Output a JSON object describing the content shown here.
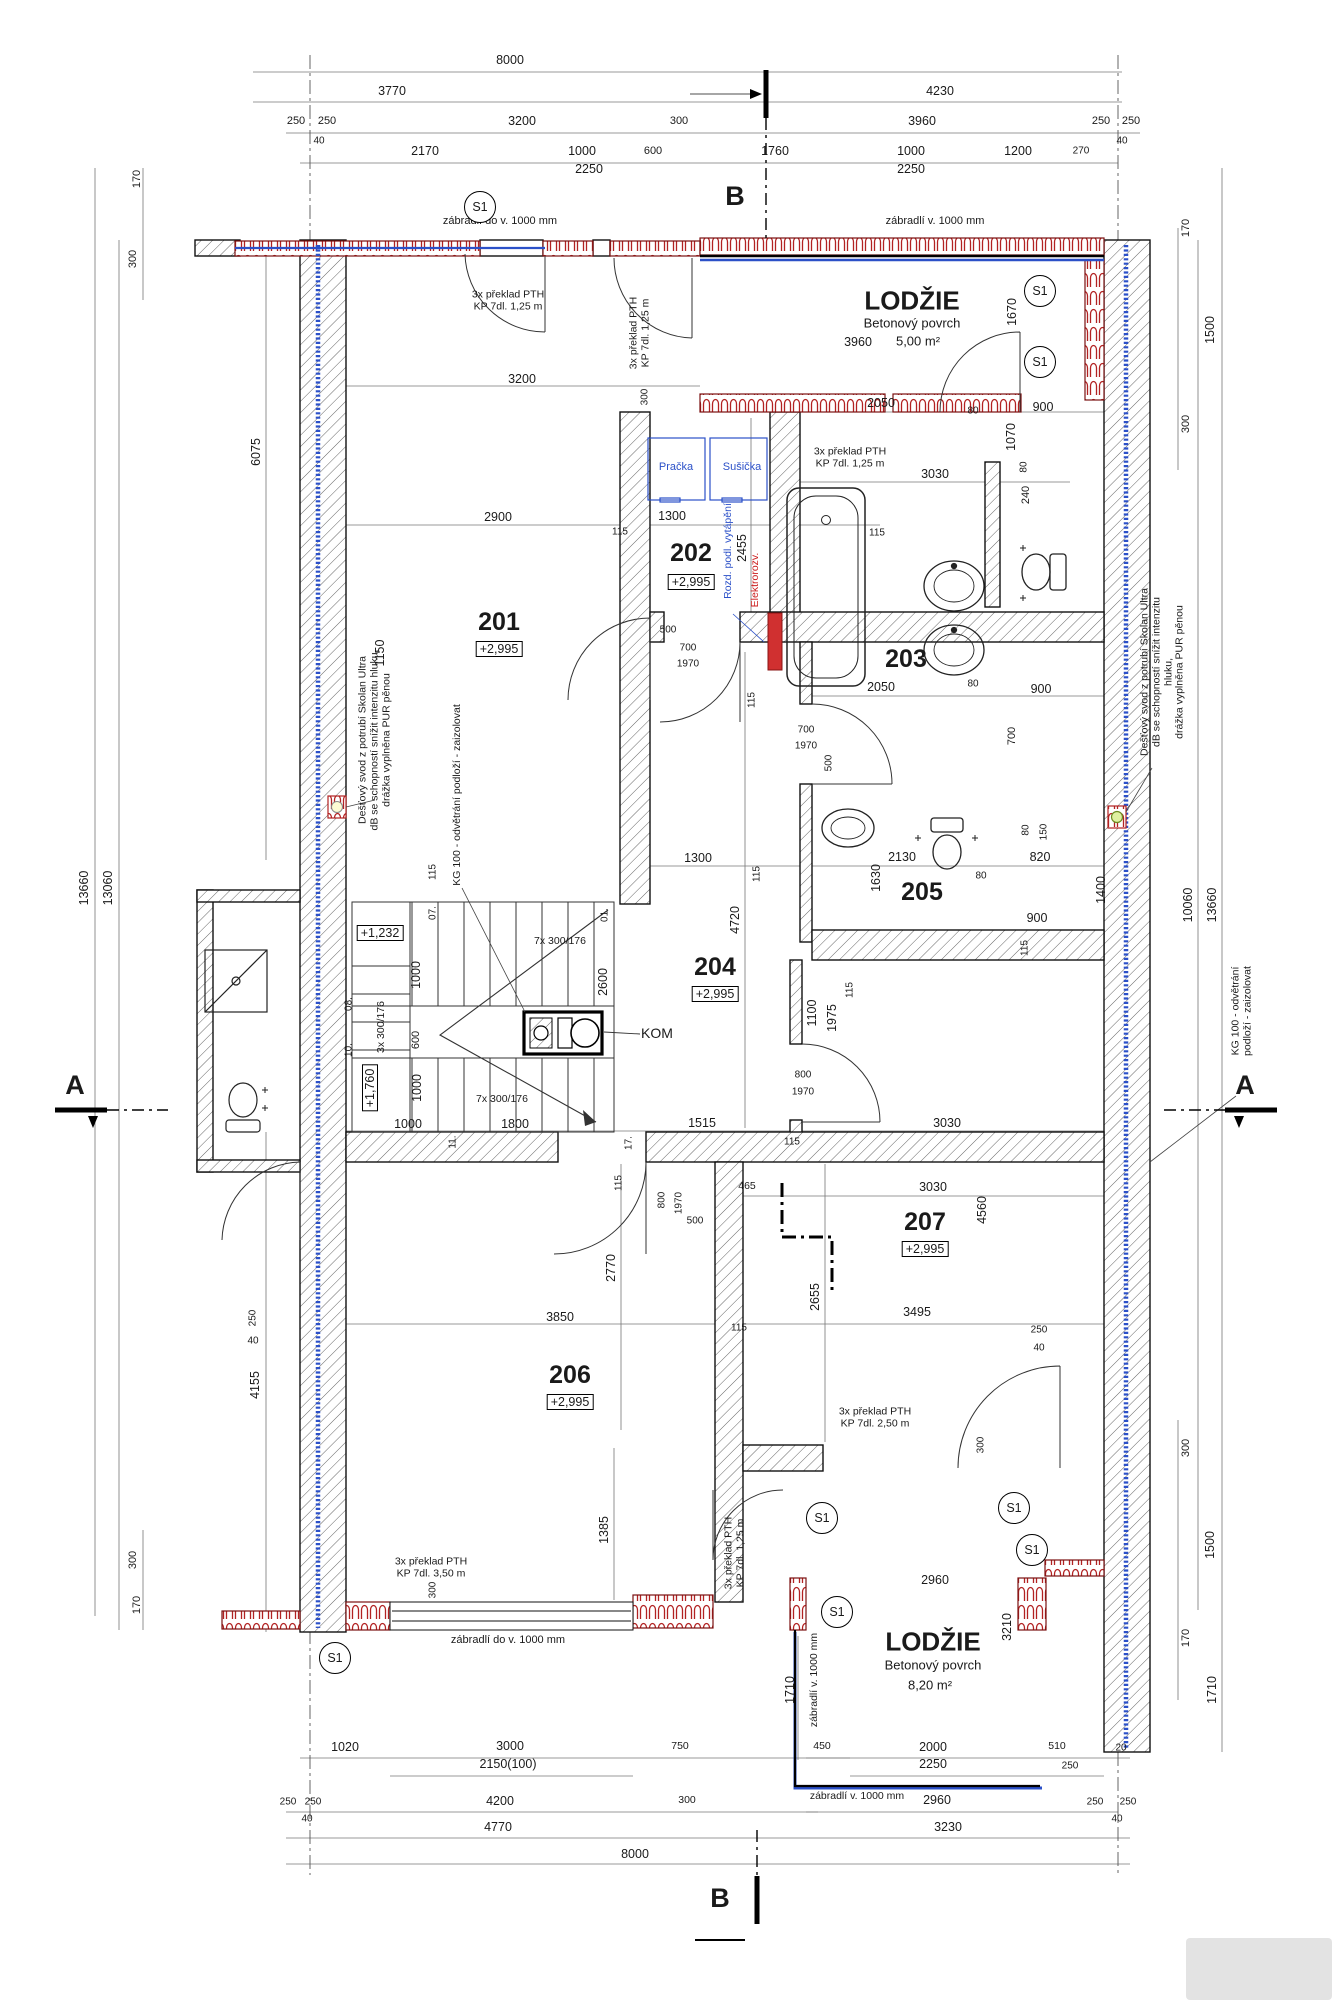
{
  "meta": {
    "drawing_type": "architectural floor plan, 2nd storey",
    "units": "mm"
  },
  "colors": {
    "wall_hatch": "#555555",
    "brick_red": "#b22222",
    "pipe_blue": "#2b50c8",
    "note_blue": "#2b50c8",
    "note_red": "#cc1f1f",
    "line": "#1a1a1a"
  },
  "rooms": [
    {
      "number": "201",
      "level": "+2,995"
    },
    {
      "number": "202",
      "level": "+2,995"
    },
    {
      "number": "203",
      "level": ""
    },
    {
      "number": "204",
      "level": "+2,995"
    },
    {
      "number": "205",
      "level": ""
    },
    {
      "number": "206",
      "level": "+2,995"
    },
    {
      "number": "207",
      "level": "+2,995"
    },
    {
      "name": "LODŽIE",
      "surface": "Betonový povrch",
      "area": "5,00 m²"
    },
    {
      "name": "LODŽIE",
      "surface": "Betonový povrch",
      "area": "8,20 m²"
    }
  ],
  "annotations": [
    {
      "t": "8000",
      "x": 510,
      "y": 60
    },
    {
      "t": "3770",
      "x": 392,
      "y": 91
    },
    {
      "t": "4230",
      "x": 940,
      "y": 91
    },
    {
      "t": "250",
      "x": 296,
      "y": 121,
      "s": 11
    },
    {
      "t": "250",
      "x": 327,
      "y": 121,
      "s": 11
    },
    {
      "t": "40",
      "x": 319,
      "y": 141,
      "s": 10
    },
    {
      "t": "3200",
      "x": 522,
      "y": 121
    },
    {
      "t": "300",
      "x": 679,
      "y": 121,
      "s": 11
    },
    {
      "t": "3960",
      "x": 922,
      "y": 121
    },
    {
      "t": "250",
      "x": 1101,
      "y": 121,
      "s": 11
    },
    {
      "t": "250",
      "x": 1131,
      "y": 121,
      "s": 11
    },
    {
      "t": "40",
      "x": 1122,
      "y": 141,
      "s": 10
    },
    {
      "t": "2170",
      "x": 425,
      "y": 151
    },
    {
      "t": "1000",
      "x": 582,
      "y": 151
    },
    {
      "t": "600",
      "x": 653,
      "y": 151,
      "s": 11
    },
    {
      "t": "1760",
      "x": 775,
      "y": 151
    },
    {
      "t": "1000",
      "x": 911,
      "y": 151
    },
    {
      "t": "1200",
      "x": 1018,
      "y": 151
    },
    {
      "t": "270",
      "x": 1081,
      "y": 151,
      "s": 10
    },
    {
      "t": "2250",
      "x": 589,
      "y": 169
    },
    {
      "t": "2250",
      "x": 911,
      "y": 169
    },
    {
      "t": "B",
      "x": 735,
      "y": 196,
      "s": 27,
      "b": 1,
      "n": "section-marker-b"
    },
    {
      "t": "zábradlí do v. 1000 mm",
      "x": 500,
      "y": 221,
      "s": 11,
      "n": "railing-note"
    },
    {
      "t": "zábradlí v. 1000 mm",
      "x": 935,
      "y": 221,
      "s": 11,
      "n": "railing-note"
    },
    {
      "t": "S1",
      "x": 480,
      "y": 207,
      "o": "circ",
      "n": "detail-marker"
    },
    {
      "t": "S1",
      "x": 1040,
      "y": 291,
      "o": "circ",
      "n": "detail-marker"
    },
    {
      "t": "S1",
      "x": 1040,
      "y": 362,
      "o": "circ",
      "n": "detail-marker"
    },
    {
      "t": "170",
      "x": 137,
      "y": 179,
      "r": -90,
      "s": 11
    },
    {
      "t": "300",
      "x": 133,
      "y": 259,
      "r": -90,
      "s": 11
    },
    {
      "t": "170",
      "x": 1186,
      "y": 228,
      "r": -90,
      "s": 11
    },
    {
      "t": "1500",
      "x": 1210,
      "y": 330,
      "r": -90
    },
    {
      "t": "300",
      "x": 1186,
      "y": 424,
      "r": -90,
      "s": 11
    },
    {
      "t": "1670",
      "x": 1012,
      "y": 312,
      "r": -90
    },
    {
      "t": "3x překlad PTH\nKP 7dl. 1,25 m",
      "x": 508,
      "y": 301,
      "s": 10.5,
      "n": "lintel-note"
    },
    {
      "t": "3x překlad PTH\nKP 7dl. 1,25 m",
      "x": 640,
      "y": 333,
      "r": -90,
      "s": 10.5,
      "n": "lintel-note"
    },
    {
      "t": "LODŽIE",
      "x": 912,
      "y": 301,
      "s": 26,
      "b": 1,
      "n": "room-label"
    },
    {
      "t": "Betonový povrch",
      "x": 912,
      "y": 324,
      "s": 13,
      "n": "room-sublabel"
    },
    {
      "t": "5,00 m²",
      "x": 918,
      "y": 342,
      "s": 13,
      "n": "room-area"
    },
    {
      "t": "3960",
      "x": 858,
      "y": 342
    },
    {
      "t": "3200",
      "x": 522,
      "y": 379
    },
    {
      "t": "300",
      "x": 645,
      "y": 397,
      "r": -90,
      "s": 10
    },
    {
      "t": "3x překlad PTH\nKP 7dl. 1,25 m",
      "x": 850,
      "y": 458,
      "s": 10.5,
      "n": "lintel-note"
    },
    {
      "t": "3030",
      "x": 935,
      "y": 474
    },
    {
      "t": "Pračka",
      "x": 676,
      "y": 467,
      "c": "b",
      "s": 11,
      "n": "appliance-label"
    },
    {
      "t": "Sušička",
      "x": 742,
      "y": 467,
      "c": "b",
      "s": 11,
      "n": "appliance-label"
    },
    {
      "t": "2900",
      "x": 498,
      "y": 517
    },
    {
      "t": "115",
      "x": 620,
      "y": 532,
      "s": 10
    },
    {
      "t": "1300",
      "x": 672,
      "y": 516
    },
    {
      "t": "115",
      "x": 877,
      "y": 533,
      "s": 10
    },
    {
      "t": "2455",
      "x": 742,
      "y": 548,
      "r": -90
    },
    {
      "t": "2050",
      "x": 881,
      "y": 403
    },
    {
      "t": "80",
      "x": 973,
      "y": 411,
      "s": 10
    },
    {
      "t": "900",
      "x": 1043,
      "y": 407
    },
    {
      "t": "1070",
      "x": 1011,
      "y": 437,
      "r": -90
    },
    {
      "t": "80",
      "x": 1024,
      "y": 467,
      "r": -90,
      "s": 10
    },
    {
      "t": "240",
      "x": 1026,
      "y": 495,
      "r": -90,
      "s": 11
    },
    {
      "t": "201",
      "x": 499,
      "y": 622,
      "s": 25,
      "b": 1,
      "n": "room-label"
    },
    {
      "t": "+2,995",
      "x": 499,
      "y": 649,
      "f": 1,
      "n": "level-label"
    },
    {
      "t": "6075",
      "x": 256,
      "y": 452,
      "r": -90
    },
    {
      "t": "202",
      "x": 691,
      "y": 553,
      "s": 25,
      "b": 1,
      "n": "room-label"
    },
    {
      "t": "+2,995",
      "x": 691,
      "y": 582,
      "f": 1,
      "n": "level-label"
    },
    {
      "t": "Rozd. podl. vytápění",
      "x": 729,
      "y": 551,
      "r": -90,
      "c": "b",
      "s": 10.5,
      "n": "installation-note"
    },
    {
      "t": "Elektrorozv.",
      "x": 756,
      "y": 580,
      "r": -90,
      "c": "r",
      "s": 10.5,
      "n": "installation-note"
    },
    {
      "t": "203",
      "x": 906,
      "y": 659,
      "s": 25,
      "b": 1,
      "n": "room-label"
    },
    {
      "t": "2050",
      "x": 881,
      "y": 687
    },
    {
      "t": "80",
      "x": 973,
      "y": 684,
      "s": 10
    },
    {
      "t": "900",
      "x": 1041,
      "y": 689
    },
    {
      "t": "700",
      "x": 1012,
      "y": 736,
      "r": -90,
      "s": 11
    },
    {
      "t": "500",
      "x": 668,
      "y": 630,
      "s": 10
    },
    {
      "t": "700",
      "x": 688,
      "y": 648,
      "s": 10
    },
    {
      "t": "1970",
      "x": 688,
      "y": 664,
      "s": 10
    },
    {
      "t": "700",
      "x": 806,
      "y": 730,
      "s": 10
    },
    {
      "t": "1970",
      "x": 806,
      "y": 746,
      "s": 10
    },
    {
      "t": "500",
      "x": 829,
      "y": 763,
      "r": -90,
      "s": 10
    },
    {
      "t": "115",
      "x": 752,
      "y": 700,
      "r": -90,
      "s": 10
    },
    {
      "t": "Dešťový svod z potrubí Skolan Ultra\ndB se schopností snížit intenzitu hluku,\ndrážka vyplněna PUR pěnou",
      "x": 375,
      "y": 740,
      "r": -90,
      "s": 10.5,
      "n": "pipe-note"
    },
    {
      "t": "KG 100 - odvětrání podloží - zaizolovat",
      "x": 458,
      "y": 795,
      "r": -90,
      "s": 10.5,
      "n": "pipe-note"
    },
    {
      "t": "Dešťový svod z potrubí Skolan Ultra\ndB se schopností snížit intenzitu hluku,\ndrážka vyplněna PUR pěnou",
      "x": 1163,
      "y": 672,
      "r": -90,
      "s": 10.5,
      "n": "pipe-note"
    },
    {
      "t": "KG 100 - odvětrání podloží - zaizolovat",
      "x": 1242,
      "y": 1011,
      "r": -90,
      "s": 10.5,
      "n": "pipe-note"
    },
    {
      "t": "+1,232",
      "x": 380,
      "y": 933,
      "f": 1,
      "n": "level-label"
    },
    {
      "t": "07.",
      "x": 433,
      "y": 913,
      "r": -90,
      "s": 10,
      "n": "step-number"
    },
    {
      "t": "01.",
      "x": 605,
      "y": 915,
      "r": -90,
      "s": 10,
      "n": "step-number"
    },
    {
      "t": "7x 300/176",
      "x": 560,
      "y": 942,
      "s": 10.5,
      "n": "stair-note"
    },
    {
      "t": "1000",
      "x": 416,
      "y": 975,
      "r": -90
    },
    {
      "t": "2600",
      "x": 603,
      "y": 982,
      "r": -90
    },
    {
      "t": "08.",
      "x": 349,
      "y": 1004,
      "r": -90,
      "s": 10,
      "n": "step-number"
    },
    {
      "t": "3x 300/176",
      "x": 382,
      "y": 1027,
      "r": -90,
      "s": 10.5,
      "n": "stair-note"
    },
    {
      "t": "600",
      "x": 416,
      "y": 1040,
      "r": -90,
      "s": 11
    },
    {
      "t": "10.",
      "x": 349,
      "y": 1050,
      "r": -90,
      "s": 10,
      "n": "step-number"
    },
    {
      "t": "+1,760",
      "x": 370,
      "y": 1088,
      "r": -90,
      "f": 1,
      "n": "level-label"
    },
    {
      "t": "1000",
      "x": 417,
      "y": 1088,
      "r": -90
    },
    {
      "t": "7x 300/176",
      "x": 502,
      "y": 1100,
      "s": 10.5,
      "n": "stair-note"
    },
    {
      "t": "1000",
      "x": 408,
      "y": 1124
    },
    {
      "t": "1800",
      "x": 515,
      "y": 1124
    },
    {
      "t": "11.",
      "x": 453,
      "y": 1142,
      "r": -90,
      "s": 10,
      "n": "step-number"
    },
    {
      "t": "17.",
      "x": 629,
      "y": 1143,
      "r": -90,
      "s": 10,
      "n": "step-number"
    },
    {
      "t": "KOM",
      "x": 657,
      "y": 1034,
      "s": 14,
      "n": "chimney-label"
    },
    {
      "t": "1150",
      "x": 380,
      "y": 653,
      "r": -90
    },
    {
      "t": "115",
      "x": 433,
      "y": 872,
      "r": -90,
      "s": 10
    },
    {
      "t": "1300",
      "x": 698,
      "y": 858
    },
    {
      "t": "115",
      "x": 757,
      "y": 874,
      "r": -90,
      "s": 10
    },
    {
      "t": "4720",
      "x": 735,
      "y": 920,
      "r": -90
    },
    {
      "t": "204",
      "x": 715,
      "y": 967,
      "s": 25,
      "b": 1,
      "n": "room-label"
    },
    {
      "t": "+2,995",
      "x": 715,
      "y": 994,
      "f": 1,
      "n": "level-label"
    },
    {
      "t": "205",
      "x": 922,
      "y": 892,
      "s": 25,
      "b": 1,
      "n": "room-label"
    },
    {
      "t": "2130",
      "x": 902,
      "y": 857
    },
    {
      "t": "1630",
      "x": 876,
      "y": 878,
      "r": -90
    },
    {
      "t": "80",
      "x": 981,
      "y": 876,
      "s": 10
    },
    {
      "t": "1400",
      "x": 1101,
      "y": 890,
      "r": -90
    },
    {
      "t": "900",
      "x": 1037,
      "y": 918
    },
    {
      "t": "115",
      "x": 1025,
      "y": 948,
      "r": -90,
      "s": 10
    },
    {
      "t": "80",
      "x": 1026,
      "y": 830,
      "r": -90,
      "s": 10
    },
    {
      "t": "150",
      "x": 1044,
      "y": 832,
      "r": -90,
      "s": 10
    },
    {
      "t": "820",
      "x": 1040,
      "y": 857
    },
    {
      "t": "115",
      "x": 850,
      "y": 990,
      "r": -90,
      "s": 10
    },
    {
      "t": "1100",
      "x": 812,
      "y": 1013,
      "r": -90
    },
    {
      "t": "1975",
      "x": 832,
      "y": 1018,
      "r": -90
    },
    {
      "t": "800",
      "x": 803,
      "y": 1075,
      "s": 10
    },
    {
      "t": "1970",
      "x": 803,
      "y": 1092,
      "s": 10
    },
    {
      "t": "1515",
      "x": 702,
      "y": 1123
    },
    {
      "t": "3030",
      "x": 947,
      "y": 1123
    },
    {
      "t": "115",
      "x": 792,
      "y": 1142,
      "s": 10
    },
    {
      "t": "465",
      "x": 747,
      "y": 1187,
      "s": 10.5
    },
    {
      "t": "3030",
      "x": 933,
      "y": 1187
    },
    {
      "t": "4560",
      "x": 982,
      "y": 1210,
      "r": -90
    },
    {
      "t": "207",
      "x": 925,
      "y": 1222,
      "s": 25,
      "b": 1,
      "n": "room-label"
    },
    {
      "t": "+2,995",
      "x": 925,
      "y": 1249,
      "f": 1,
      "n": "level-label"
    },
    {
      "t": "2655",
      "x": 815,
      "y": 1297,
      "r": -90
    },
    {
      "t": "3495",
      "x": 917,
      "y": 1312
    },
    {
      "t": "115",
      "x": 739,
      "y": 1328,
      "s": 10
    },
    {
      "t": "250",
      "x": 1039,
      "y": 1330,
      "s": 10
    },
    {
      "t": "40",
      "x": 1039,
      "y": 1348,
      "s": 10
    },
    {
      "t": "800",
      "x": 662,
      "y": 1200,
      "r": -90,
      "s": 10
    },
    {
      "t": "1970",
      "x": 679,
      "y": 1203,
      "r": -90,
      "s": 10
    },
    {
      "t": "500",
      "x": 695,
      "y": 1221,
      "s": 10
    },
    {
      "t": "115",
      "x": 619,
      "y": 1183,
      "r": -90,
      "s": 10
    },
    {
      "t": "2770",
      "x": 611,
      "y": 1268,
      "r": -90
    },
    {
      "t": "3850",
      "x": 560,
      "y": 1317
    },
    {
      "t": "206",
      "x": 570,
      "y": 1375,
      "s": 25,
      "b": 1,
      "n": "room-label"
    },
    {
      "t": "+2,995",
      "x": 570,
      "y": 1402,
      "f": 1,
      "n": "level-label"
    },
    {
      "t": "4155",
      "x": 255,
      "y": 1385,
      "r": -90
    },
    {
      "t": "250",
      "x": 253,
      "y": 1318,
      "r": -90,
      "s": 10
    },
    {
      "t": "40",
      "x": 253,
      "y": 1341,
      "s": 10
    },
    {
      "t": "3x překlad PTH\nKP 7dl. 2,50 m",
      "x": 875,
      "y": 1418,
      "s": 10.5,
      "n": "lintel-note"
    },
    {
      "t": "300",
      "x": 981,
      "y": 1445,
      "r": -90,
      "s": 10
    },
    {
      "t": "3x překlad PTH\nKP 7dl. 3,50 m",
      "x": 431,
      "y": 1568,
      "s": 10.5,
      "n": "lintel-note"
    },
    {
      "t": "3x překlad PTH\nKP 7dl. 1,25 m",
      "x": 735,
      "y": 1553,
      "r": -90,
      "s": 10.5,
      "n": "lintel-note"
    },
    {
      "t": "1385",
      "x": 604,
      "y": 1530,
      "r": -90
    },
    {
      "t": "300",
      "x": 433,
      "y": 1590,
      "r": -90,
      "s": 10
    },
    {
      "t": "S1",
      "x": 822,
      "y": 1518,
      "o": "circ",
      "n": "detail-marker"
    },
    {
      "t": "S1",
      "x": 1014,
      "y": 1508,
      "o": "circ",
      "n": "detail-marker"
    },
    {
      "t": "S1",
      "x": 1032,
      "y": 1550,
      "o": "circ",
      "n": "detail-marker"
    },
    {
      "t": "S1",
      "x": 837,
      "y": 1612,
      "o": "circ",
      "n": "detail-marker"
    },
    {
      "t": "S1",
      "x": 335,
      "y": 1658,
      "o": "circ",
      "n": "detail-marker"
    },
    {
      "t": "2960",
      "x": 935,
      "y": 1580
    },
    {
      "t": "3210",
      "x": 1007,
      "y": 1627,
      "r": -90
    },
    {
      "t": "LODŽIE",
      "x": 933,
      "y": 1642,
      "s": 26,
      "b": 1,
      "n": "room-label"
    },
    {
      "t": "Betonový povrch",
      "x": 933,
      "y": 1666,
      "s": 13,
      "n": "room-sublabel"
    },
    {
      "t": "8,20 m²",
      "x": 930,
      "y": 1686,
      "s": 13,
      "n": "room-area"
    },
    {
      "t": "zábradlí v. 1000 mm",
      "x": 815,
      "y": 1680,
      "r": -90,
      "s": 10.5,
      "n": "railing-note"
    },
    {
      "t": "1710",
      "x": 790,
      "y": 1690,
      "r": -90
    },
    {
      "t": "450",
      "x": 822,
      "y": 1747,
      "s": 10.5
    },
    {
      "t": "2000",
      "x": 933,
      "y": 1747
    },
    {
      "t": "510",
      "x": 1057,
      "y": 1747,
      "s": 10.5
    },
    {
      "t": "20",
      "x": 1121,
      "y": 1748,
      "s": 10
    },
    {
      "t": "2250",
      "x": 933,
      "y": 1764
    },
    {
      "t": "250",
      "x": 1070,
      "y": 1766,
      "s": 10
    },
    {
      "t": "zábradlí v. 1000 mm",
      "x": 857,
      "y": 1797,
      "s": 10.5,
      "n": "railing-note"
    },
    {
      "t": "2960",
      "x": 937,
      "y": 1800
    },
    {
      "t": "250",
      "x": 1095,
      "y": 1802,
      "s": 10
    },
    {
      "t": "250",
      "x": 1128,
      "y": 1802,
      "s": 10
    },
    {
      "t": "40",
      "x": 1117,
      "y": 1819,
      "s": 10
    },
    {
      "t": "3230",
      "x": 948,
      "y": 1827
    },
    {
      "t": "zábradlí do v. 1000 mm",
      "x": 508,
      "y": 1640,
      "s": 11,
      "n": "railing-note"
    },
    {
      "t": "1020",
      "x": 345,
      "y": 1747
    },
    {
      "t": "3000",
      "x": 510,
      "y": 1746
    },
    {
      "t": "750",
      "x": 680,
      "y": 1747,
      "s": 10.5
    },
    {
      "t": "2150(100)",
      "x": 508,
      "y": 1764
    },
    {
      "t": "250",
      "x": 288,
      "y": 1802,
      "s": 10
    },
    {
      "t": "250",
      "x": 313,
      "y": 1802,
      "s": 10
    },
    {
      "t": "40",
      "x": 307,
      "y": 1819,
      "s": 10
    },
    {
      "t": "4200",
      "x": 500,
      "y": 1801
    },
    {
      "t": "300",
      "x": 687,
      "y": 1801,
      "s": 10.5
    },
    {
      "t": "4770",
      "x": 498,
      "y": 1827
    },
    {
      "t": "8000",
      "x": 635,
      "y": 1854
    },
    {
      "t": "B",
      "x": 720,
      "y": 1898,
      "s": 27,
      "b": 1,
      "n": "section-marker-b"
    },
    {
      "t": "13660",
      "x": 84,
      "y": 888,
      "r": -90
    },
    {
      "t": "13060",
      "x": 108,
      "y": 888,
      "r": -90
    },
    {
      "t": "300",
      "x": 133,
      "y": 1560,
      "r": -90,
      "s": 11
    },
    {
      "t": "170",
      "x": 137,
      "y": 1605,
      "r": -90,
      "s": 11
    },
    {
      "t": "10060",
      "x": 1188,
      "y": 905,
      "r": -90
    },
    {
      "t": "13660",
      "x": 1212,
      "y": 905,
      "r": -90
    },
    {
      "t": "300",
      "x": 1186,
      "y": 1448,
      "r": -90,
      "s": 11
    },
    {
      "t": "1500",
      "x": 1210,
      "y": 1545,
      "r": -90
    },
    {
      "t": "170",
      "x": 1186,
      "y": 1638,
      "r": -90,
      "s": 11
    },
    {
      "t": "1710",
      "x": 1212,
      "y": 1690,
      "r": -90
    },
    {
      "t": "A",
      "x": 75,
      "y": 1085,
      "s": 27,
      "b": 1,
      "n": "section-marker-a"
    },
    {
      "t": "A",
      "x": 1245,
      "y": 1085,
      "s": 27,
      "b": 1,
      "n": "section-marker-a"
    }
  ]
}
